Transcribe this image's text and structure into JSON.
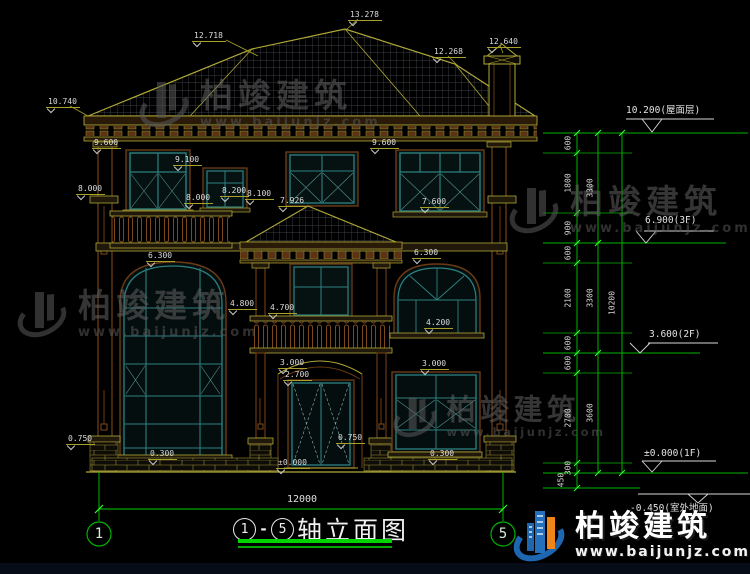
{
  "brand": {
    "name": "柏竣建筑",
    "site": "www.baijunjz.com"
  },
  "title": {
    "from": "1",
    "separator": "-",
    "to": "5",
    "name": "轴立面图"
  },
  "axes": {
    "left": "1",
    "right": "5"
  },
  "overall_width": "12000",
  "elevations": [
    "12.718",
    "13.278",
    "12.268",
    "12.640",
    "10.740",
    "9.600",
    "9.100",
    "8.000",
    "8.000",
    "8.200",
    "8.100",
    "7.926",
    "9.600",
    "7.600",
    "6.300",
    "6.300",
    "4.800",
    "4.700",
    "4.200",
    "3.000",
    "2.700",
    "3.000",
    "±0.000",
    "0.750",
    "0.300",
    "0.750",
    "0.300"
  ],
  "chain": {
    "segments": [
      "600",
      "1800",
      "900",
      "600",
      "2100",
      "600",
      "600",
      "2700",
      "300",
      "450"
    ],
    "totals": [
      "3300",
      "3300",
      "3600",
      "10200"
    ]
  },
  "levels": [
    "10.200(屋面层)",
    "6.900(3F)",
    "3.600(2F)",
    "±0.000(1F)",
    "-0.450(室外地面)"
  ]
}
